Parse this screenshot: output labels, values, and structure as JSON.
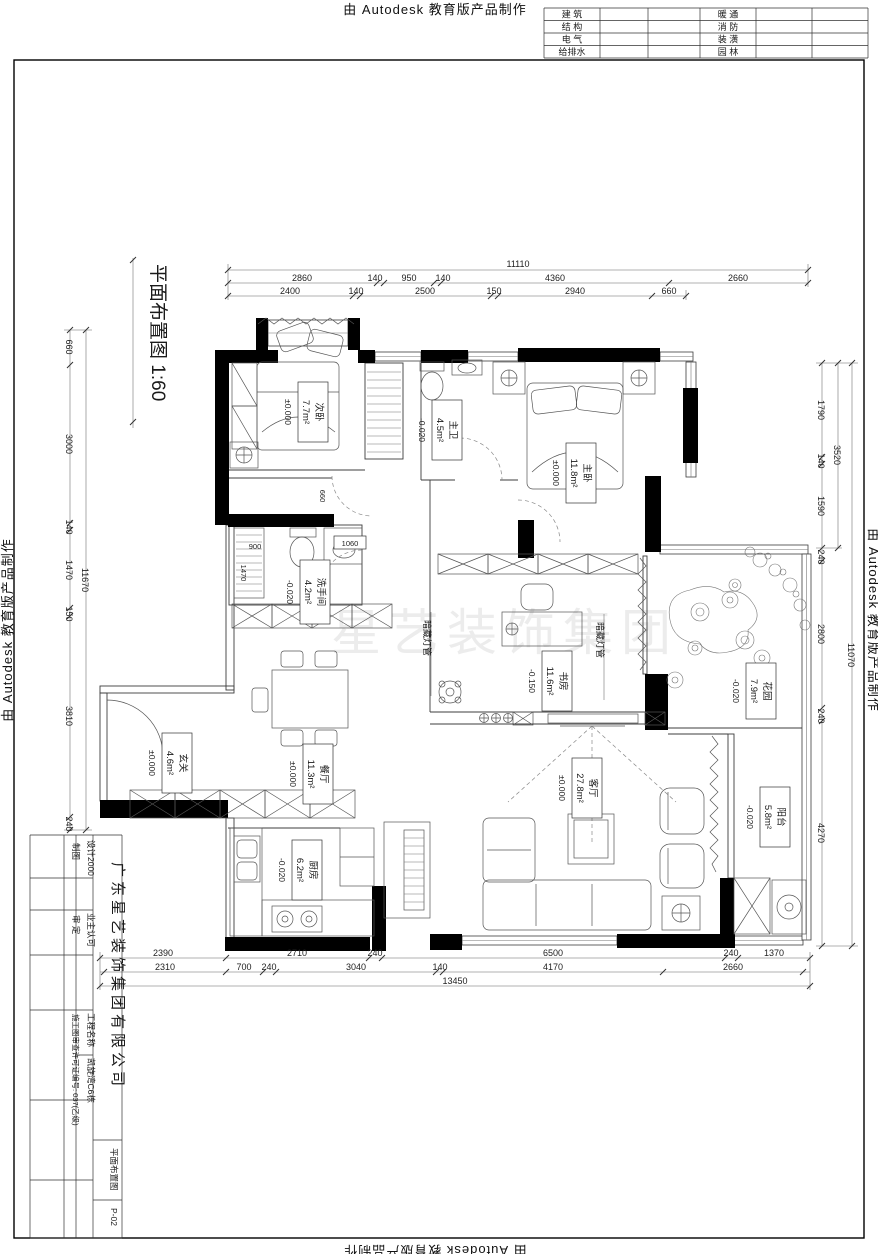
{
  "watermarks": {
    "autodesk": "由 Autodesk 教育版产品制作",
    "center": "星艺装饰集团"
  },
  "plan": {
    "title": "平面布置图  1:60"
  },
  "discipline_table": {
    "left": [
      "建 筑",
      "结 构",
      "电 气",
      "给排水"
    ],
    "right": [
      "暖 通",
      "消 防",
      "装 潢",
      "园 林"
    ]
  },
  "rooms": [
    {
      "name": "次卧",
      "area": "7.7m²",
      "elev": "±0.000"
    },
    {
      "name": "主卫",
      "area": "4.5m²",
      "elev": "-0.020"
    },
    {
      "name": "主卧",
      "area": "11.8m²",
      "elev": "±0.000"
    },
    {
      "name": "洗手间",
      "area": "4.2m²",
      "elev": "-0.020"
    },
    {
      "name": "书房",
      "area": "11.6m²",
      "elev": "-0.150"
    },
    {
      "name": "花园",
      "area": "7.9m²",
      "elev": "-0.020"
    },
    {
      "name": "玄关",
      "area": "4.6m²",
      "elev": "±0.000"
    },
    {
      "name": "餐厅",
      "area": "11.3m²",
      "elev": "±0.000"
    },
    {
      "name": "客厅",
      "area": "27.8m²",
      "elev": "±0.000"
    },
    {
      "name": "厨房",
      "area": "6.2m²",
      "elev": "-0.020"
    },
    {
      "name": "阳台",
      "area": "5.8m²",
      "elev": "-0.020"
    }
  ],
  "notes": {
    "hidden_light": "暗藏灯管"
  },
  "dims": {
    "top": {
      "total": "11110",
      "row2": [
        "2860",
        "140",
        "950",
        "140",
        "4360",
        "2660"
      ],
      "row3": [
        "2400",
        "140",
        "2500",
        "150",
        "2940",
        "660"
      ]
    },
    "bottom": {
      "row1": [
        "2390",
        "2710",
        "240",
        "6500",
        "240",
        "1370"
      ],
      "row2": [
        "2310",
        "700",
        "240",
        "3040",
        "140",
        "4170",
        "2660"
      ],
      "total": "13450"
    },
    "left": {
      "chain": [
        "660",
        "3000",
        "140",
        "1470",
        "150",
        "3810",
        "240"
      ],
      "total": "11670"
    },
    "right": {
      "chain": [
        "1790",
        "140",
        "1590",
        "240",
        "2800",
        "240",
        "4270"
      ],
      "sub": "3520",
      "total": "11070"
    },
    "interior": [
      "900",
      "1470",
      "1060",
      "660"
    ]
  },
  "title_block": {
    "company": "广东星艺装饰集团有限公司",
    "design_label": "设计2000",
    "draft_label": "制图",
    "review_label": "审 定",
    "owner_approval": "业主认可",
    "project_label": "工程名称",
    "project_name": "凯旋湾C6栋",
    "license": "施工图审查许可证编号: 037(乙级)",
    "drawing_name": "平面布置图",
    "sheet_no": "P-02"
  }
}
